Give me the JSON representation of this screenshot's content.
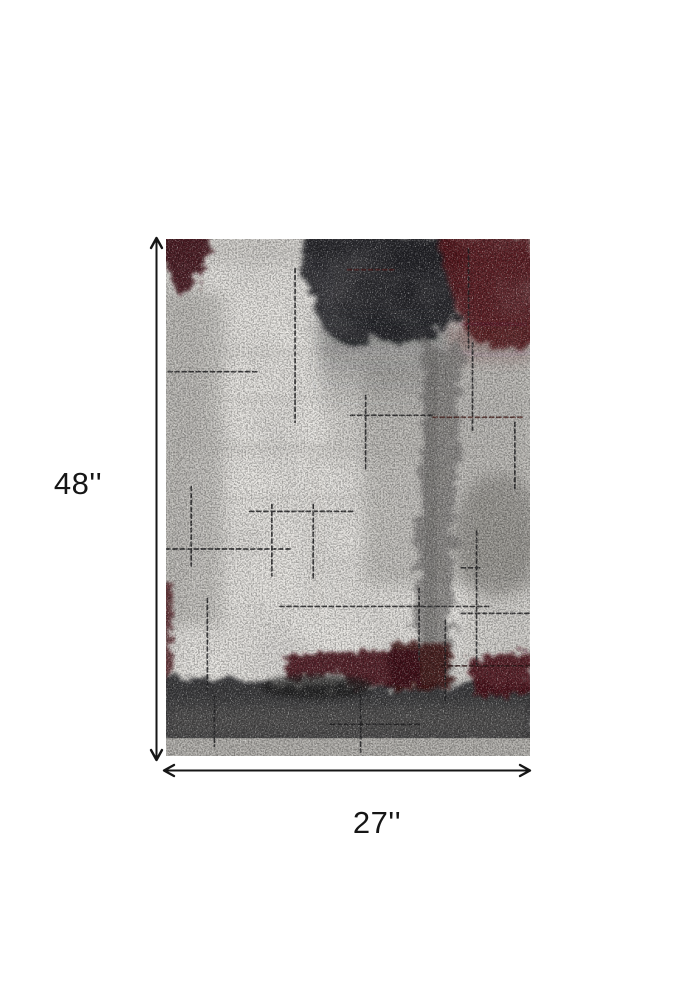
{
  "figure": {
    "image_name": "abstract-area-rug",
    "height_label": "48''",
    "width_label": "27''"
  },
  "colors": {
    "background": "#ffffff",
    "annotation": "#161616",
    "rug_base": "#d8d6d2",
    "rug_light_patch": "#edebe7",
    "rug_mid_gray": "#a9a7a3",
    "rug_charcoal_mass": "#1b1d21",
    "rug_dark_red": "#56171c",
    "rug_maroon": "#401015",
    "rug_gray_streak": "#7e7c7a",
    "rug_bottom_band": "#3a3a3c",
    "rug_bottom_strip": "#b4b2ae"
  }
}
